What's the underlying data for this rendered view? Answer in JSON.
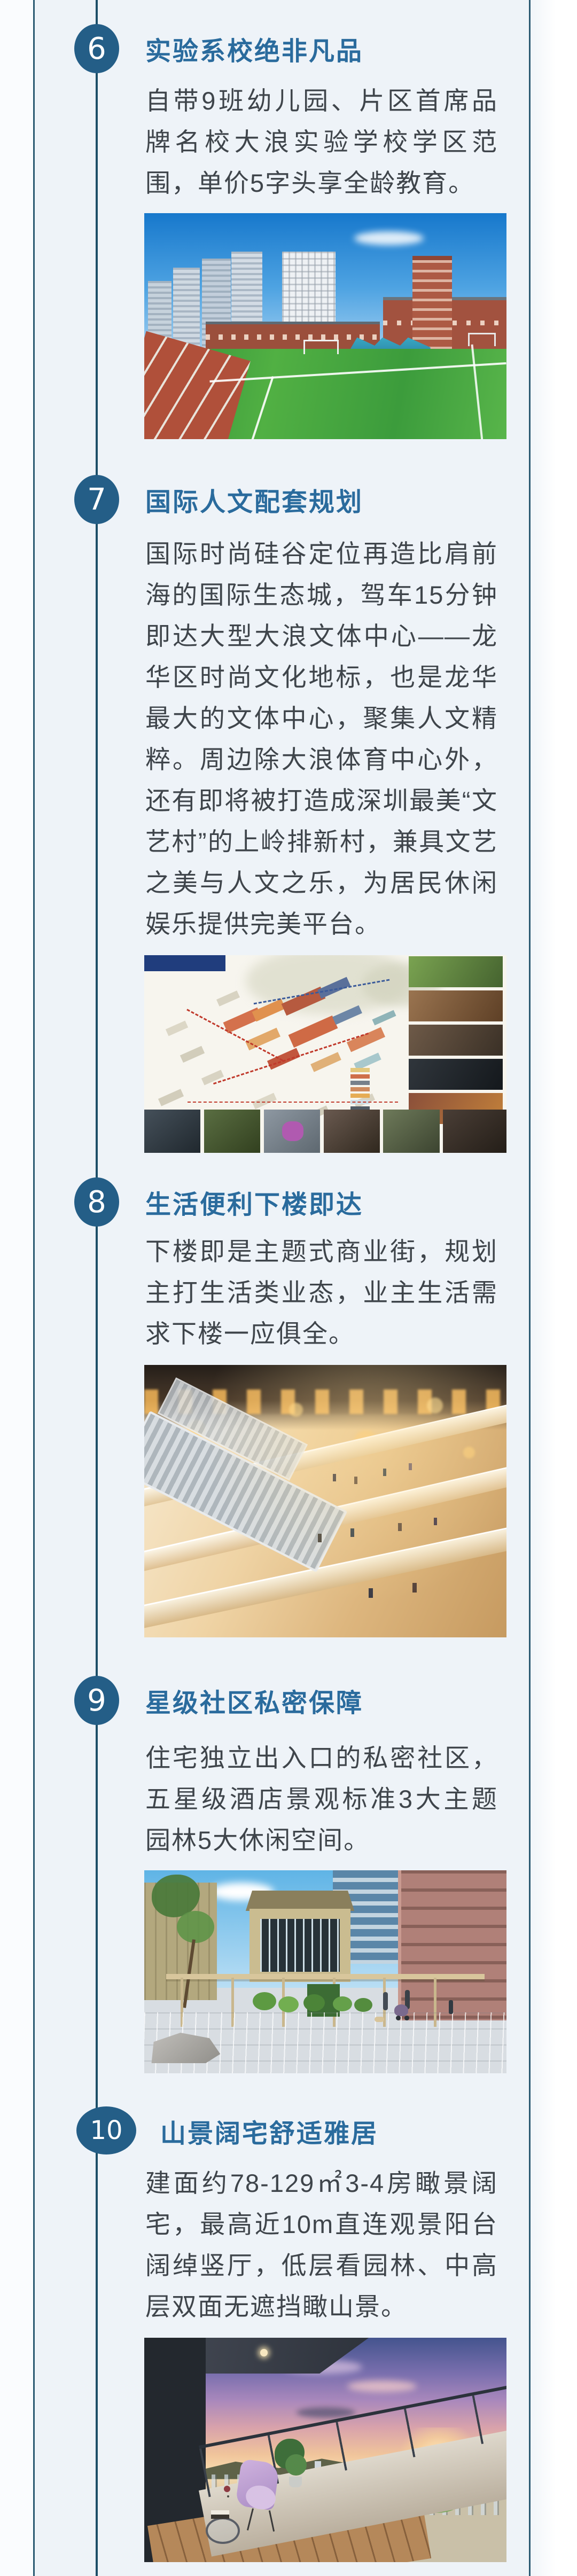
{
  "theme": {
    "badge_color": "#245e87",
    "title_color": "#2a6b9d",
    "timeline_color": "#1d4f68",
    "border_color": "#2b5a72",
    "panel_bg": "#eef3f8",
    "body_text_color": "#3f454b"
  },
  "sections": [
    {
      "number": "6",
      "title": "实验系校绝非凡品",
      "body": "自带9班幼儿园、片区首席品牌名校大浪实验学校学区范围，单价5字头享全龄教育。",
      "image_name": "school-sports-field-photo"
    },
    {
      "number": "7",
      "title": "国际人文配套规划",
      "body": "国际时尚硅谷定位再造比肩前海的国际生态城，驾车15分钟即达大型大浪文体中心——龙华区时尚文化地标，也是龙华最大的文体中心，聚集人文精粹。周边除大浪体育中心外，还有即将被打造成深圳最美“文艺村”的上岭排新村，兼具文艺之美与人文之乐，为居民休闲娱乐提供完美平台。",
      "image_name": "culture-village-masterplan-photo"
    },
    {
      "number": "8",
      "title": "生活便利下楼即达",
      "body": "下楼即是主题式商业街，规划主打生活类业态，业主生活需求下楼一应俱全。",
      "image_name": "shopping-mall-interior-photo"
    },
    {
      "number": "9",
      "title": "星级社区私密保障",
      "body": "住宅独立出入口的私密社区，五星级酒店景观标准3大主题园林5大休闲空间。",
      "image_name": "community-courtyard-photo"
    },
    {
      "number": "10",
      "title": "山景阔宅舒适雅居",
      "body": "建面约78-129㎡3-4房瞰景阔宅，最高近10m直连观景阳台阔绰竖厅，低层看园林、中高层双面无遮挡瞰山景。",
      "image_name": "balcony-mountain-view-photo"
    }
  ]
}
